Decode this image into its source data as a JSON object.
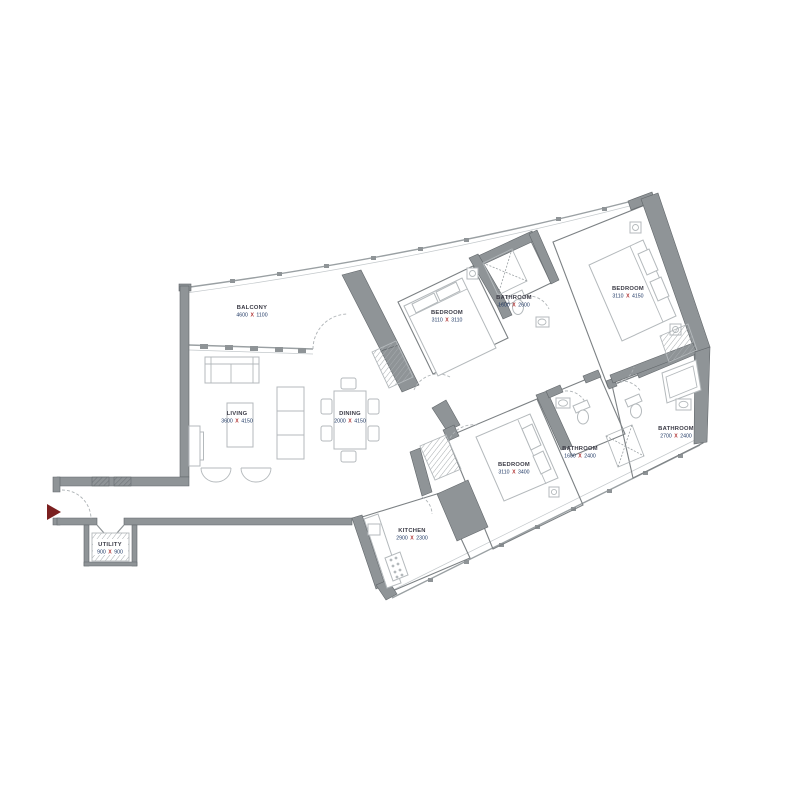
{
  "dim_separator": "X",
  "rooms": [
    {
      "id": "balcony",
      "label": "BALCONY",
      "width": "4600",
      "height": "1100"
    },
    {
      "id": "living",
      "label": "LIVING",
      "width": "3600",
      "height": "4150"
    },
    {
      "id": "dining",
      "label": "DINING",
      "width": "2000",
      "height": "4150"
    },
    {
      "id": "bedroom-1",
      "label": "BEDROOM",
      "width": "3110",
      "height": "3110"
    },
    {
      "id": "bathroom-1",
      "label": "BATHROOM",
      "width": "1600",
      "height": "2600"
    },
    {
      "id": "bedroom-2",
      "label": "BEDROOM",
      "width": "3110",
      "height": "4150"
    },
    {
      "id": "bedroom-3",
      "label": "BEDROOM",
      "width": "3110",
      "height": "3400"
    },
    {
      "id": "bathroom-2",
      "label": "BATHROOM",
      "width": "1600",
      "height": "2400"
    },
    {
      "id": "bathroom-3",
      "label": "BATHROOM",
      "width": "2700",
      "height": "2400"
    },
    {
      "id": "kitchen",
      "label": "KITCHEN",
      "width": "2900",
      "height": "2300"
    },
    {
      "id": "utility",
      "label": "UTILITY",
      "width": "900",
      "height": "900"
    }
  ],
  "colors": {
    "wall": "#8f9497",
    "wall_dark": "#61666a",
    "furniture": "#b4b9bc",
    "label": "#3a3a45",
    "dimension": "#1f3864",
    "separator": "#b03434",
    "entry_arrow": "#7b1f1f"
  }
}
